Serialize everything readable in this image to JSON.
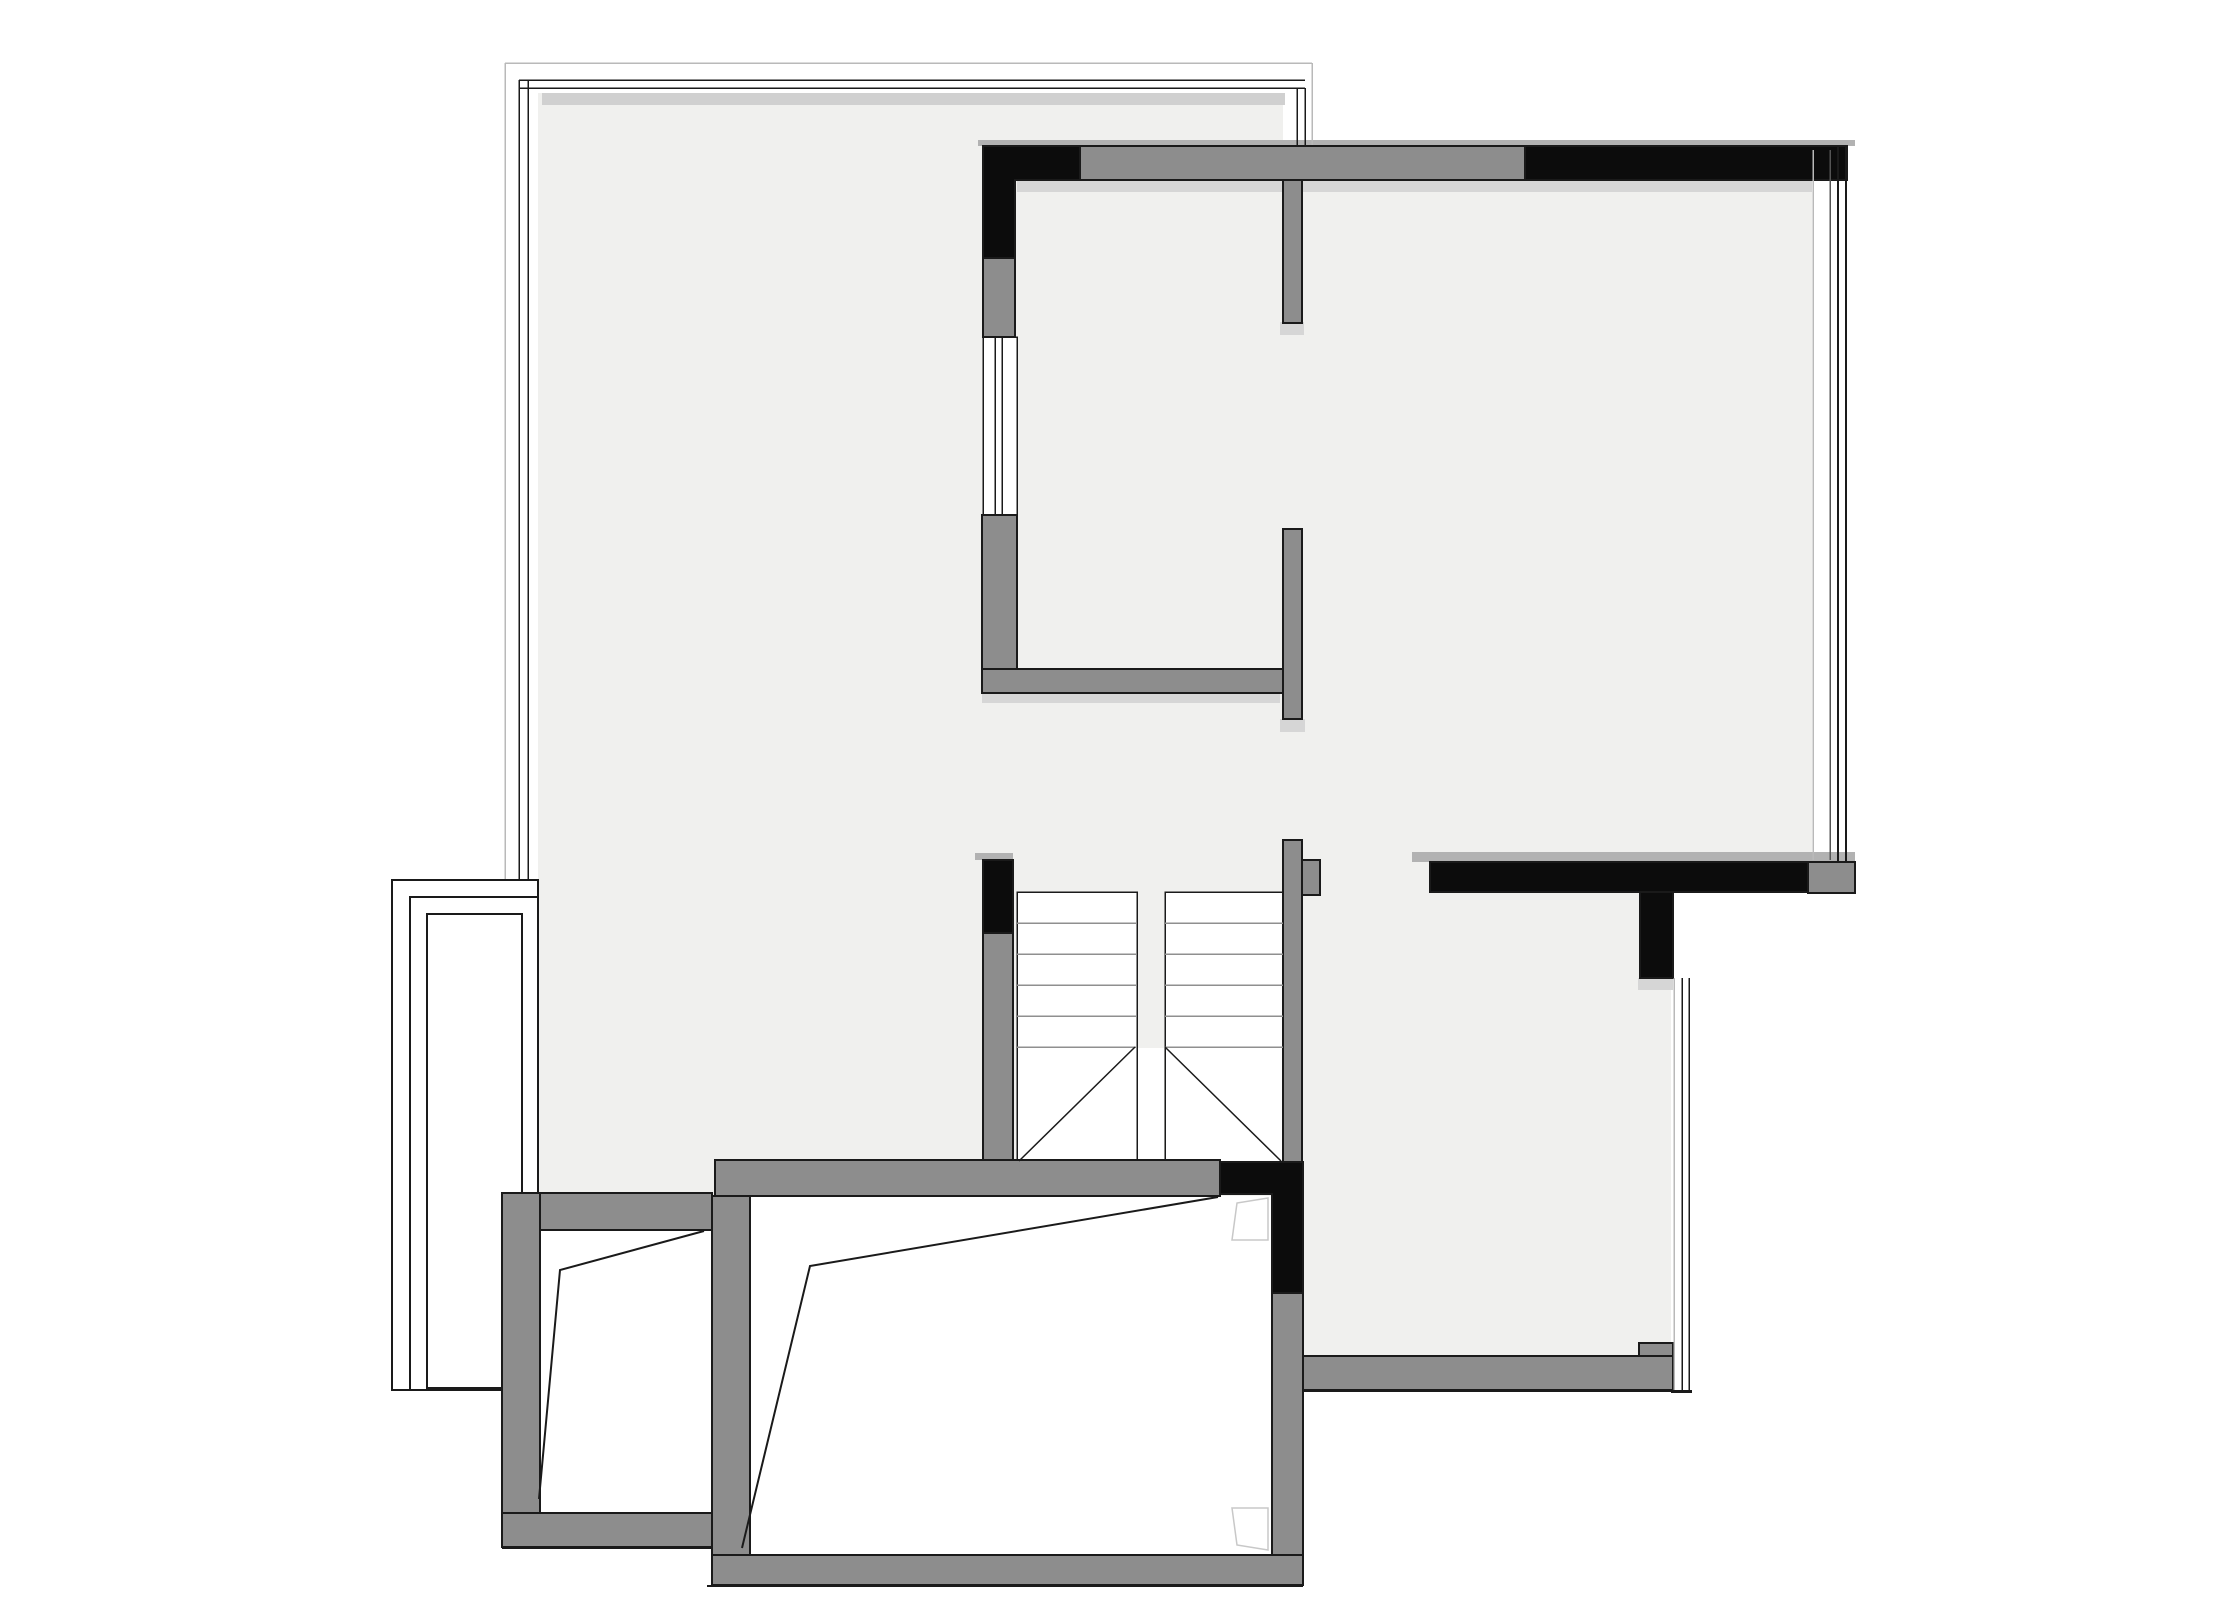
{
  "meta": {
    "drawing_type": "architectural-floor-plan",
    "visible_text": []
  },
  "canvas": {
    "width": 2218,
    "height": 1621,
    "background": "#ffffff"
  },
  "palette": {
    "room_fill": "#f0f0ee",
    "band": "#d0d0d0",
    "shadow": "#d6d6d6",
    "shadow_dark": "#b2b2b2",
    "wall_gray": "#8d8d8d",
    "wall_black": "#0c0c0c",
    "line": "#1a1a1a",
    "faint": "#b9b9b9",
    "mid": "#555555",
    "tread": "#8f8f8f",
    "symbol": "#c8c8c8",
    "white": "#ffffff"
  },
  "plan": {
    "layers": [
      {
        "name": "room-fills",
        "type": "rect",
        "f": "$room_fill",
        "items": [
          {
            "n": "room-area-upper-left",
            "b": [
              538,
              93,
              745,
              1103
            ]
          },
          {
            "n": "room-area-upper-right",
            "b": [
              1283,
              180,
              529,
              682
            ]
          },
          {
            "n": "passage-opening",
            "b": [
              1310,
              862,
              120,
              30
            ]
          },
          {
            "n": "room-area-lower-right",
            "b": [
              1303,
              892,
              368,
              464
            ]
          }
        ]
      },
      {
        "name": "shadows",
        "type": "rect",
        "items": [
          {
            "n": "top-interior-band",
            "b": [
              542,
              93,
              743,
              12
            ],
            "f": "$band"
          },
          {
            "n": "shadow-above-top-wall",
            "b": [
              978,
              140,
              877,
              6
            ],
            "f": "$shadow_dark"
          },
          {
            "n": "shadow-below-top-wall-left",
            "b": [
              1017,
              180,
              266,
              12
            ],
            "f": "$shadow"
          },
          {
            "n": "shadow-below-top-wall-right",
            "b": [
              1302,
              180,
              510,
              12
            ],
            "f": "$shadow"
          },
          {
            "n": "shadow-divider-end",
            "b": [
              1280,
              322,
              24,
              13
            ],
            "f": "$shadow"
          },
          {
            "n": "shadow-below-u-wall",
            "b": [
              982,
              693,
              298,
              10
            ],
            "f": "$shadow"
          },
          {
            "n": "shadow-below-u-wall-right",
            "b": [
              1280,
              719,
              25,
              13
            ],
            "f": "$shadow"
          },
          {
            "n": "shadow-above-stair-wall",
            "b": [
              975,
              853,
              38,
              7
            ],
            "f": "$shadow_dark"
          },
          {
            "n": "shadow-above-black-wall-right",
            "b": [
              1412,
              852,
              443,
              10
            ],
            "f": "$shadow_dark"
          },
          {
            "n": "shadow-below-black-stub",
            "b": [
              1638,
              978,
              35,
              12
            ],
            "f": "$shadow"
          }
        ]
      },
      {
        "name": "frame-lines",
        "type": "line",
        "s": "$line",
        "sw": 1.5,
        "items": [
          {
            "n": "outer-frame-top",
            "p": [
              505,
              63,
              1312,
              63
            ],
            "s": "$faint"
          },
          {
            "n": "outer-frame-left",
            "p": [
              505,
              63,
              505,
              1196
            ],
            "s": "$faint"
          },
          {
            "n": "outer-frame-right",
            "p": [
              1312,
              63,
              1312,
              146
            ],
            "s": "$faint"
          },
          {
            "n": "window-top-line-1",
            "p": [
              519,
              80,
              1305,
              80
            ]
          },
          {
            "n": "window-top-line-2",
            "p": [
              519,
              88,
              1305,
              88
            ]
          },
          {
            "n": "window-left-line-1",
            "p": [
              519,
              80,
              519,
              880
            ]
          },
          {
            "n": "window-left-line-2",
            "p": [
              528,
              80,
              528,
              880
            ]
          },
          {
            "n": "window-right-line-1",
            "p": [
              1297,
              88,
              1297,
              146
            ]
          },
          {
            "n": "window-right-line-2",
            "p": [
              1305,
              88,
              1305,
              146
            ]
          }
        ]
      },
      {
        "name": "white-areas",
        "type": "rect",
        "f": "$white",
        "s": "$line",
        "sw": 1.5,
        "items": [
          {
            "n": "window-strip-left-mid",
            "b": [
              983,
              337,
              34,
              178
            ]
          },
          {
            "n": "stair-flight-left",
            "b": [
              1017,
              892,
              120,
              271
            ]
          },
          {
            "n": "stair-flight-right",
            "b": [
              1165,
              892,
              118,
              271
            ]
          },
          {
            "n": "stair-center-landing",
            "b": [
              1138,
              1048,
              26,
              114
            ],
            "s": "none"
          },
          {
            "n": "chimney-outer-rect",
            "b": [
              392,
              880,
              146,
              510
            ],
            "sw": 2
          },
          {
            "n": "chimney-middle-rect",
            "b": [
              410,
              897,
              128,
              493
            ],
            "sw": 2
          },
          {
            "n": "chimney-inner-rect",
            "b": [
              427,
              914,
              95,
              474
            ],
            "sw": 2
          }
        ]
      },
      {
        "name": "window-strip-glass",
        "type": "line",
        "s": "$line",
        "sw": 1.5,
        "items": [
          {
            "n": "window-strip-glass-1",
            "p": [
              995,
              337,
              995,
              515
            ]
          },
          {
            "n": "window-strip-glass-2",
            "p": [
              1002,
              337,
              1002,
              515
            ]
          },
          {
            "n": "chimney-inner-line",
            "p": [
              522,
              914,
              522,
              1388
            ],
            "sw": 1
          }
        ]
      },
      {
        "name": "gray-walls",
        "type": "rect",
        "f": "$wall_gray",
        "s": "$line",
        "sw": 2,
        "items": [
          {
            "n": "wall-top-main",
            "b": [
              1080,
              146,
              445,
              34
            ]
          },
          {
            "n": "wall-divider-vertical",
            "b": [
              1283,
              180,
              19,
              143
            ]
          },
          {
            "n": "wall-left-upper-segment",
            "b": [
              983,
              258,
              32,
              79
            ]
          },
          {
            "n": "wall-u-left-vertical",
            "b": [
              982,
              515,
              35,
              178
            ]
          },
          {
            "n": "wall-u-bottom",
            "b": [
              982,
              669,
              320,
              24
            ]
          },
          {
            "n": "wall-u-right-vertical",
            "b": [
              1283,
              529,
              19,
              190
            ]
          },
          {
            "n": "wall-stair-left",
            "b": [
              983,
              933,
              30,
              230
            ]
          },
          {
            "n": "wall-stair-right",
            "b": [
              1283,
              840,
              19,
              323
            ]
          },
          {
            "n": "wall-stair-right-notch",
            "b": [
              1302,
              860,
              18,
              35
            ]
          },
          {
            "n": "wall-stairs-bottom",
            "b": [
              715,
              1160,
              505,
              36
            ]
          },
          {
            "n": "wall-room-left-top",
            "b": [
              502,
              1193,
              210,
              37
            ]
          },
          {
            "n": "wall-room-left-side",
            "b": [
              502,
              1193,
              38,
              354
            ]
          },
          {
            "n": "wall-room-left-bottom",
            "b": [
              502,
              1513,
              210,
              34
            ]
          },
          {
            "n": "wall-rooms-divider",
            "b": [
              712,
              1196,
              38,
              389
            ]
          },
          {
            "n": "wall-room-mid-bottom",
            "b": [
              712,
              1555,
              591,
              30
            ]
          },
          {
            "n": "wall-room-mid-right",
            "b": [
              1272,
              1293,
              31,
              262
            ]
          },
          {
            "n": "wall-lower-right",
            "b": [
              1303,
              1356,
              370,
              34
            ]
          },
          {
            "n": "wall-lower-right-step",
            "b": [
              1639,
              1343,
              34,
              13
            ]
          },
          {
            "n": "wall-top-right-end-cap",
            "b": [
              1808,
              862,
              47,
              31
            ]
          }
        ]
      },
      {
        "name": "black-walls",
        "type": "polygon",
        "f": "$wall_black",
        "s": "$line",
        "sw": 2,
        "items": [
          {
            "n": "black-wall-top-left-corner",
            "pts": "983,146 1080,146 1080,180 1015,180 1015,258 983,258"
          },
          {
            "n": "black-wall-lower-corner",
            "pts": "1220,1162 1303,1162 1303,1293 1272,1293 1272,1194 1220,1194"
          }
        ]
      },
      {
        "name": "black-wall-rects",
        "type": "rect",
        "f": "$wall_black",
        "s": "$line",
        "sw": 2,
        "items": [
          {
            "n": "black-wall-top-right",
            "b": [
              1525,
              146,
              322,
              34
            ]
          },
          {
            "n": "black-wall-right-row",
            "b": [
              1430,
              862,
              378,
              30
            ]
          },
          {
            "n": "black-wall-stub",
            "b": [
              1640,
              892,
              33,
              86
            ]
          },
          {
            "n": "black-wall-stair-left",
            "b": [
              983,
              860,
              30,
              73
            ]
          }
        ]
      },
      {
        "name": "stair-treads",
        "type": "line",
        "s": "$tread",
        "sw": 1.5,
        "items": [
          {
            "n": "tread-left-1",
            "p": [
              1017,
              923,
              1137,
              923
            ]
          },
          {
            "n": "tread-left-2",
            "p": [
              1017,
              954,
              1137,
              954
            ]
          },
          {
            "n": "tread-left-3",
            "p": [
              1017,
              985,
              1137,
              985
            ]
          },
          {
            "n": "tread-left-4",
            "p": [
              1017,
              1016,
              1137,
              1016
            ]
          },
          {
            "n": "tread-left-5",
            "p": [
              1017,
              1047,
              1137,
              1047
            ]
          },
          {
            "n": "tread-right-1",
            "p": [
              1165,
              923,
              1283,
              923
            ]
          },
          {
            "n": "tread-right-2",
            "p": [
              1165,
              954,
              1283,
              954
            ]
          },
          {
            "n": "tread-right-3",
            "p": [
              1165,
              985,
              1283,
              985
            ]
          },
          {
            "n": "tread-right-4",
            "p": [
              1165,
              1016,
              1283,
              1016
            ]
          },
          {
            "n": "tread-right-5",
            "p": [
              1165,
              1047,
              1283,
              1047
            ]
          }
        ]
      },
      {
        "name": "stair-diagonals",
        "type": "line",
        "s": "$line",
        "sw": 1.5,
        "sr": "geometricPrecision",
        "items": [
          {
            "n": "stair-diagonal-left",
            "p": [
              1135,
              1047,
              1019,
              1161
            ]
          },
          {
            "n": "stair-diagonal-right",
            "p": [
              1165,
              1047,
              1281,
              1161
            ]
          }
        ]
      },
      {
        "name": "window-lines-right",
        "type": "line",
        "items": [
          {
            "n": "right-window-line-1",
            "p": [
              1813,
              150,
              1813,
              860
            ],
            "s": "$faint",
            "sw": 1.5
          },
          {
            "n": "right-window-line-2",
            "p": [
              1830,
              150,
              1830,
              860
            ],
            "s": "$mid",
            "sw": 1.5
          },
          {
            "n": "right-window-line-3",
            "p": [
              1838,
              147,
              1838,
              862
            ],
            "s": "$line",
            "sw": 2
          },
          {
            "n": "right-window-line-4",
            "p": [
              1846,
              147,
              1846,
              862
            ],
            "s": "$line",
            "sw": 2
          },
          {
            "n": "lower-window-line-1",
            "p": [
              1674,
              978,
              1674,
              1392
            ],
            "s": "$faint",
            "sw": 1.5
          },
          {
            "n": "lower-window-line-2",
            "p": [
              1682,
              978,
              1682,
              1392
            ],
            "s": "$line",
            "sw": 1.5
          },
          {
            "n": "lower-window-line-3",
            "p": [
              1689,
              978,
              1689,
              1392
            ],
            "s": "$line",
            "sw": 1.5
          },
          {
            "n": "lower-window-close",
            "p": [
              1671,
              1392,
              1692,
              1392
            ],
            "s": "$line",
            "sw": 1.5
          },
          {
            "n": "under-wall-line-lower-right",
            "p": [
              1303,
              1391,
              1692,
              1391
            ],
            "s": "$line",
            "sw": 2
          },
          {
            "n": "under-wall-line-mid-room",
            "p": [
              707,
              1586,
              1303,
              1586
            ],
            "s": "$line",
            "sw": 2
          },
          {
            "n": "under-wall-line-left-room",
            "p": [
              502,
              1548,
              712,
              1548
            ],
            "s": "$line",
            "sw": 2
          }
        ]
      },
      {
        "name": "break-lines",
        "type": "polyline",
        "f": "none",
        "s": "$line",
        "sw": 2,
        "sr": "geometricPrecision",
        "items": [
          {
            "n": "ceiling-break-left-room",
            "pts": "704,1231 560,1270 539,1499"
          },
          {
            "n": "ceiling-break-mid-room",
            "pts": "1218,1197 810,1266 742,1548"
          }
        ]
      },
      {
        "name": "door-symbols",
        "type": "polygon",
        "f": "$white",
        "s": "$symbol",
        "sw": 1.5,
        "sr": "geometricPrecision",
        "items": [
          {
            "n": "door-symbol-upper",
            "pts": "1232,1240 1237,1203 1268,1198 1268,1240"
          },
          {
            "n": "door-symbol-lower",
            "pts": "1232,1508 1237,1545 1268,1550 1268,1508"
          }
        ]
      }
    ]
  }
}
